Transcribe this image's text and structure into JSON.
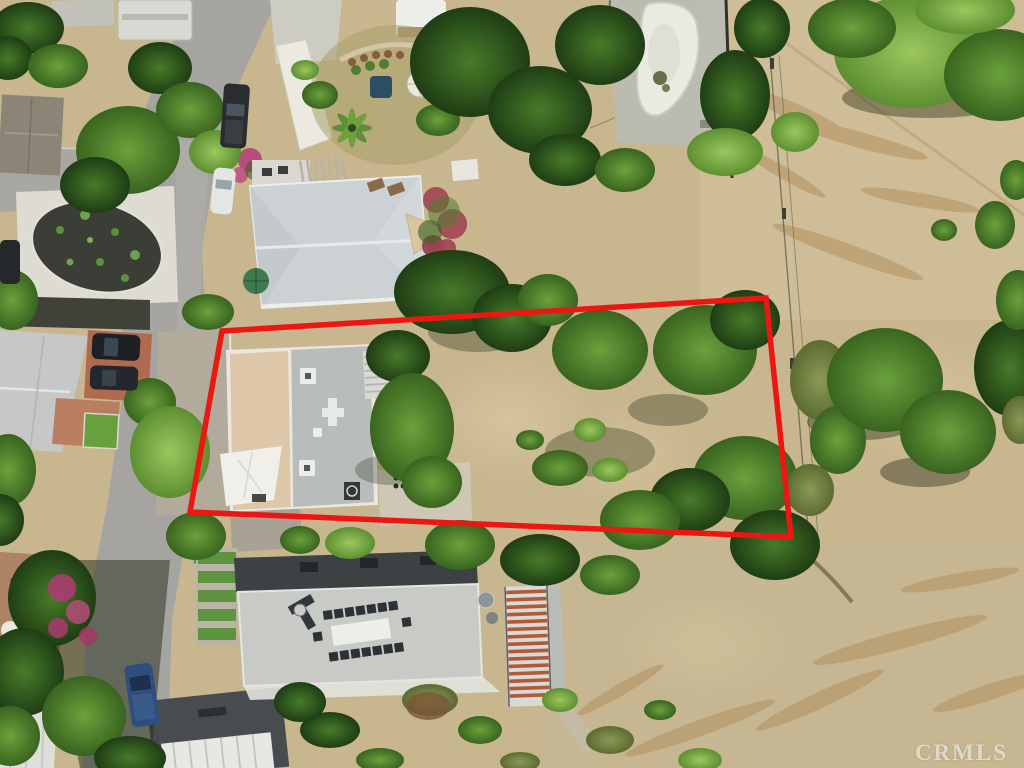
{
  "watermark": {
    "text": "CRMLS"
  },
  "colors": {
    "boundary": "#ec1612",
    "watermark": "rgba(255,255,255,0.58)",
    "dirt": "#c8b68f",
    "road": "#a5a4a0",
    "roof_gray": "#ccd2d3",
    "roof_tan": "#ddc7a8",
    "tree_dark": "#2f551d",
    "tree_mid": "#4c7c2b",
    "tree_light": "#7fb04a"
  },
  "overlay": {
    "boundary_points": "222,331 766,298 791,537 190,512",
    "boundary_stroke_width": "5.5"
  }
}
